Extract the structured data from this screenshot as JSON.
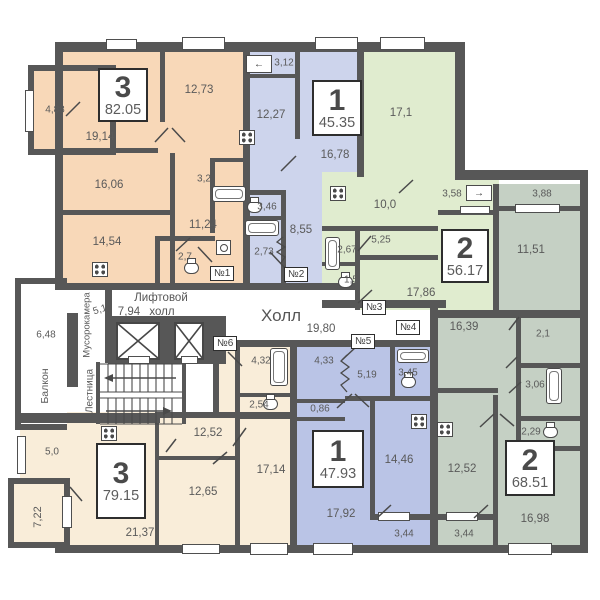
{
  "plan_type": "floor-plan",
  "colors": {
    "wall": "#575757",
    "apartment_3_top": "#f8d8b8",
    "apartment_1_top": "#cdd4ec",
    "apartment_2_right": "#e0eccf",
    "apartment_2_bottom": "#c5d0c4",
    "apartment_1_bottom": "#bac4e6",
    "apartment_3_bottom": "#f9edd9"
  },
  "icons": {
    "appliance_in": "←",
    "appliance_out": "→"
  },
  "apartments": {
    "tl": {
      "rooms": "3",
      "area": "82.05"
    },
    "tm": {
      "rooms": "1",
      "area": "45.35"
    },
    "tr": {
      "rooms": "2",
      "area": "56.17"
    },
    "br": {
      "rooms": "2",
      "area": "68.51"
    },
    "bm": {
      "rooms": "1",
      "area": "47.93"
    },
    "bl": {
      "rooms": "3",
      "area": "79.15"
    }
  },
  "tags": {
    "t1": "№1",
    "t2": "№2",
    "t3": "№3",
    "t4": "№4",
    "t5": "№5",
    "t6": "№6"
  },
  "common": {
    "hall": "Холл",
    "hall_area": "19,80",
    "lift_line1": "Лифтовой",
    "lift_line2": "холл",
    "lift_area": "7,94",
    "garbage": "Мусорокамера",
    "garbage_area": "5,1",
    "stairs": "Лестница",
    "balcony": "Балкон",
    "balcony_area": "6,48"
  },
  "rooms": {
    "tl_1": "4,88",
    "tl_2": "12,73",
    "tl_3": "19,14",
    "tl_4": "16,06",
    "tl_5": "3,2",
    "tl_6": "11,24",
    "tl_7": "14,54",
    "tl_8": "2,7",
    "tm_1": "3,12",
    "tm_2": "12,27",
    "tm_3": "16,78",
    "tm_4": "3,46",
    "tm_5": "8,55",
    "tm_6": "2,73",
    "tr_1": "17,1",
    "tr_2": "10,0",
    "tr_3": "3,58",
    "tr_4": "5,25",
    "tr_5": "2,67",
    "tr_6": "1,5",
    "tr_7": "17,86",
    "br_1": "3,88",
    "br_2": "11,51",
    "br_3": "16,39",
    "br_4": "2,1",
    "br_5": "3,06",
    "br_6": "2,29",
    "br_7": "12,52",
    "br_8": "16,98",
    "br_9": "3,44",
    "bm_1": "4,33",
    "bm_2": "5,19",
    "bm_3": "3,45",
    "bm_4": "0,86",
    "bm_5": "17,92",
    "bm_6": "14,46",
    "bm_7": "3,44",
    "bl_1": "4,32",
    "bl_2": "2,54",
    "bl_3": "17,14",
    "bl_4": "12,52",
    "bl_5": "12,65",
    "bl_6": "21,37",
    "bl_7": "5,0",
    "bl_8": "7,22"
  }
}
